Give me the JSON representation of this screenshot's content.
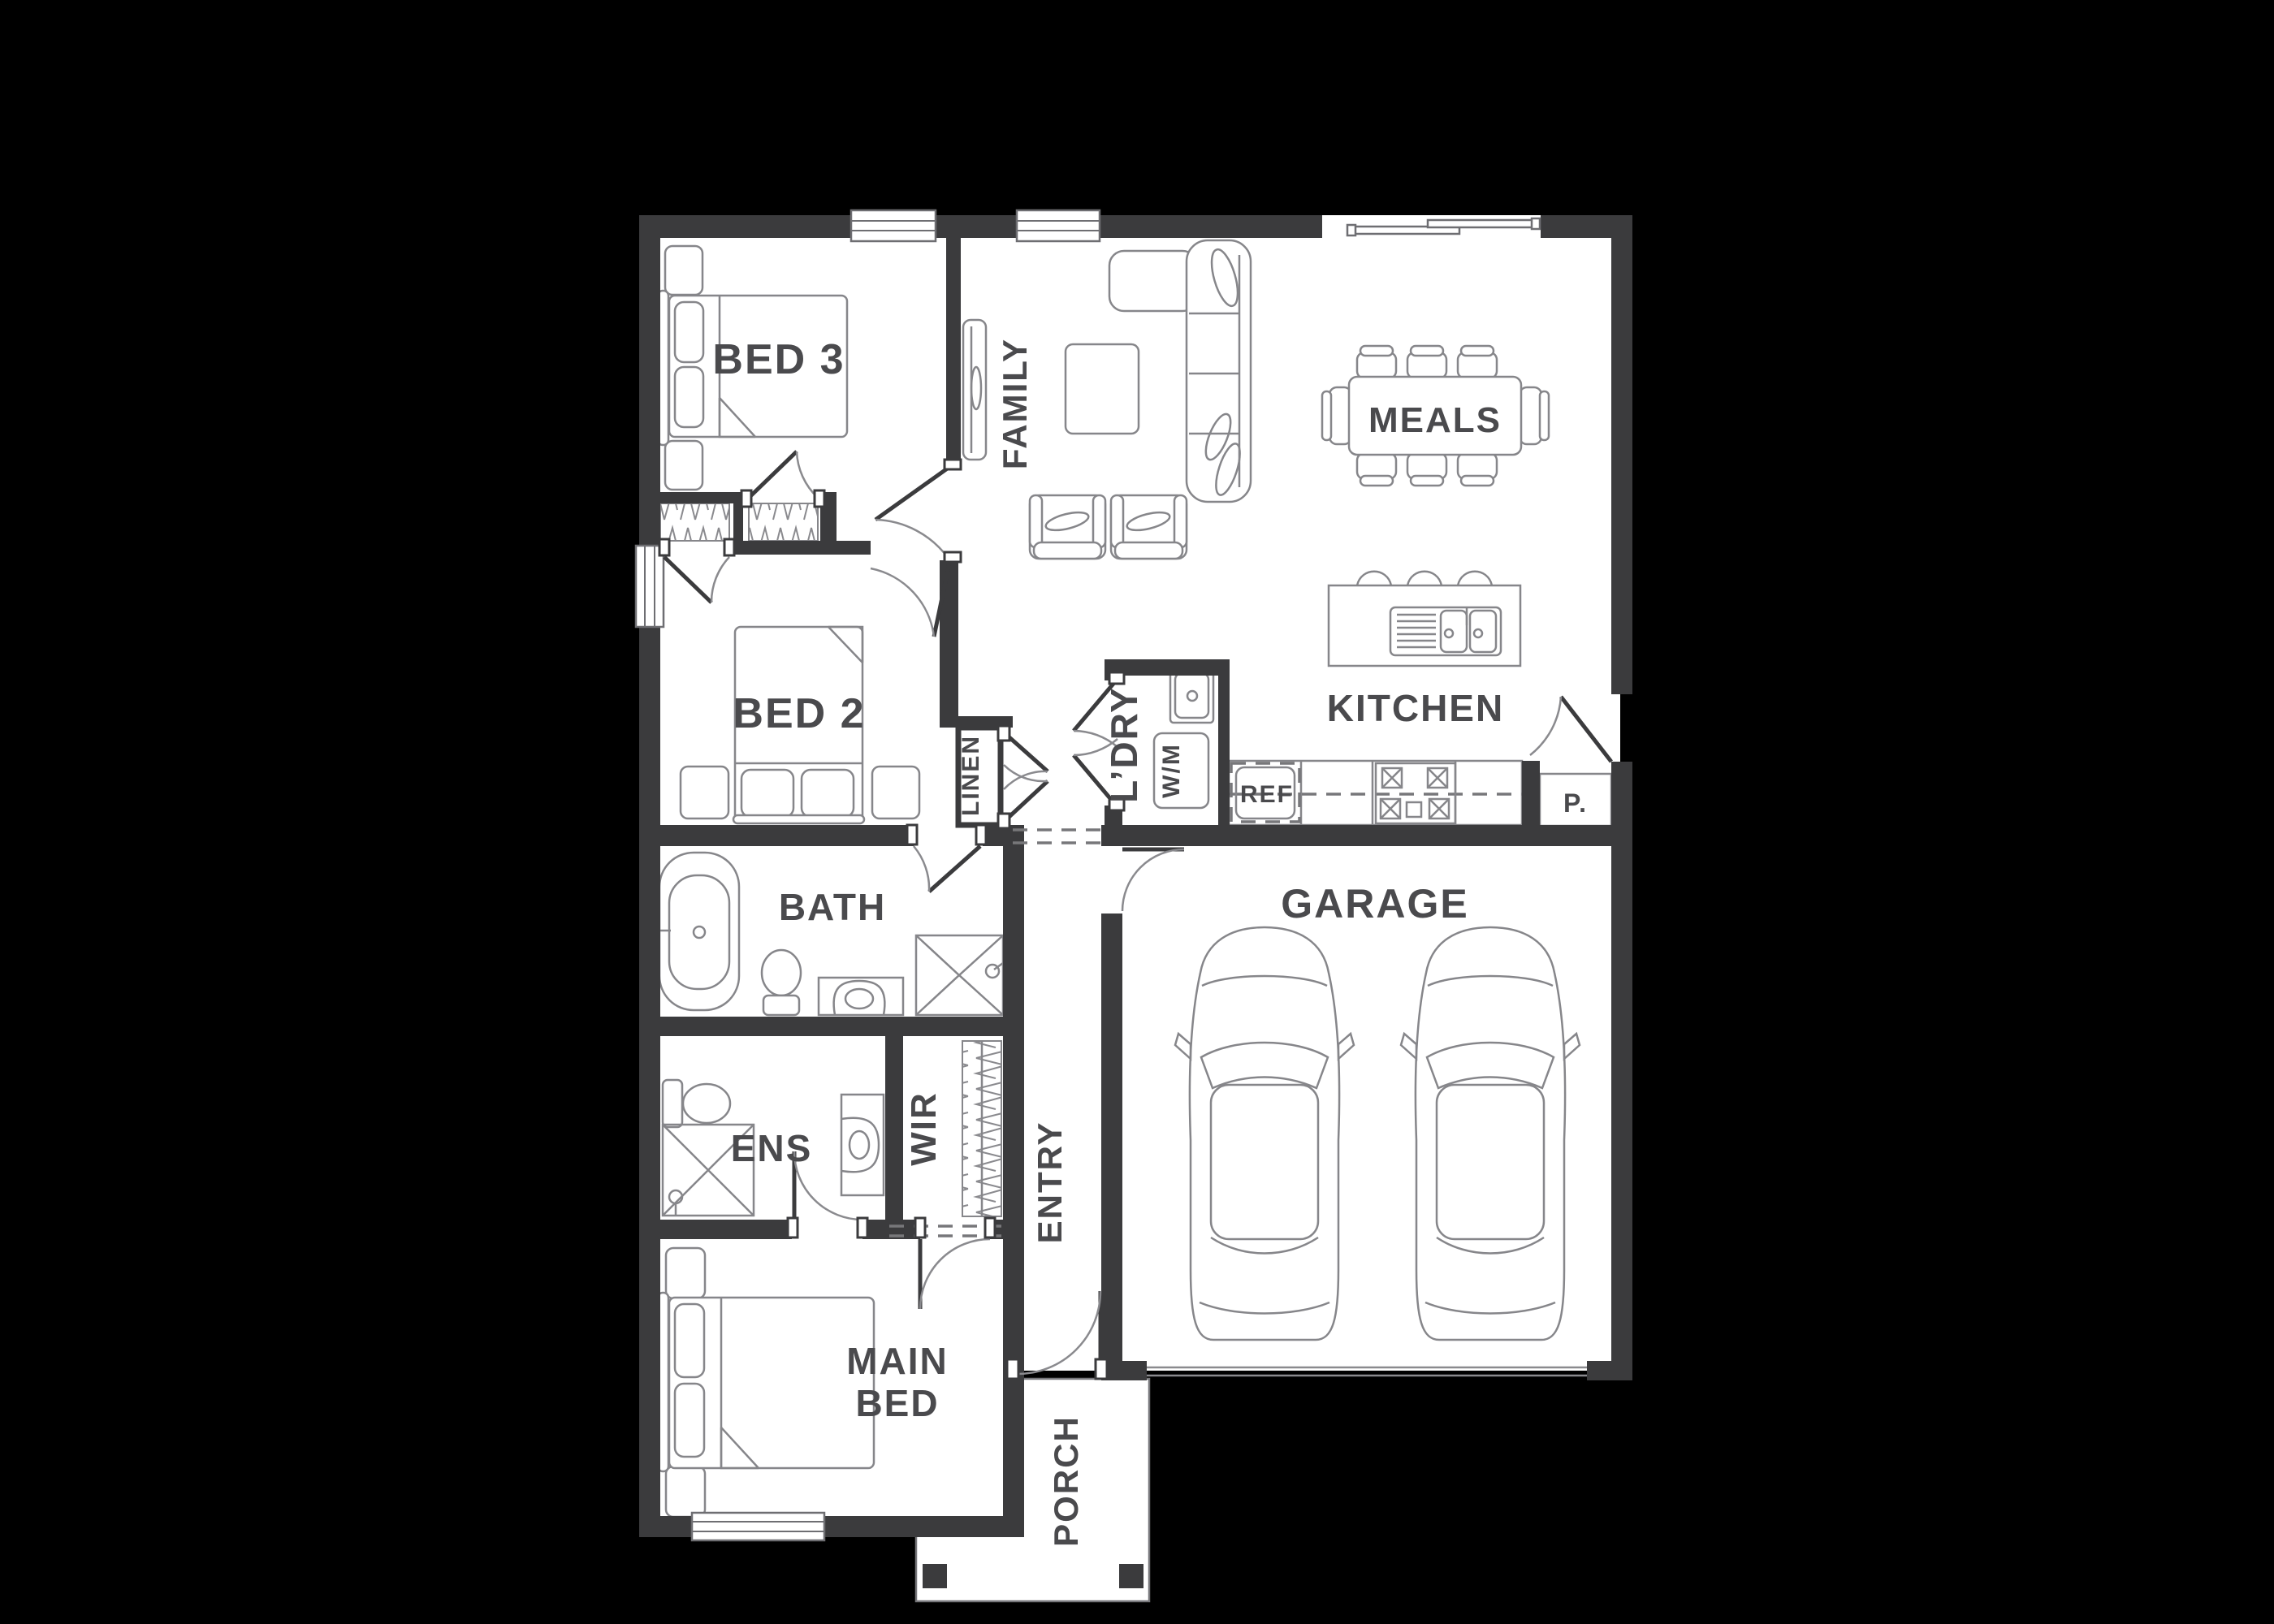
{
  "plan_title": "House floor plan",
  "palette": {
    "background": "#000000",
    "wall": "#3b3b3d",
    "floor": "#ffffff",
    "furniture_line": "#86868a",
    "label": "#4a4a4d"
  },
  "rooms": {
    "bed3": {
      "label": "BED 3"
    },
    "family": {
      "label": "FAMILY"
    },
    "meals": {
      "label": "MEALS"
    },
    "bed2": {
      "label": "BED 2"
    },
    "linen": {
      "label": "LINEN"
    },
    "laundry": {
      "label": "L’DRY"
    },
    "washing_machine": {
      "label": "W/M"
    },
    "fridge": {
      "label": "REF"
    },
    "kitchen": {
      "label": "KITCHEN"
    },
    "pantry": {
      "label": "P."
    },
    "bath": {
      "label": "BATH"
    },
    "garage": {
      "label": "GARAGE"
    },
    "ensuite": {
      "label": "ENS"
    },
    "wir": {
      "label": "WIR"
    },
    "entry": {
      "label": "ENTRY"
    },
    "main_bed": {
      "line1": "MAIN",
      "line2": "BED"
    },
    "porch": {
      "label": "PORCH"
    }
  }
}
